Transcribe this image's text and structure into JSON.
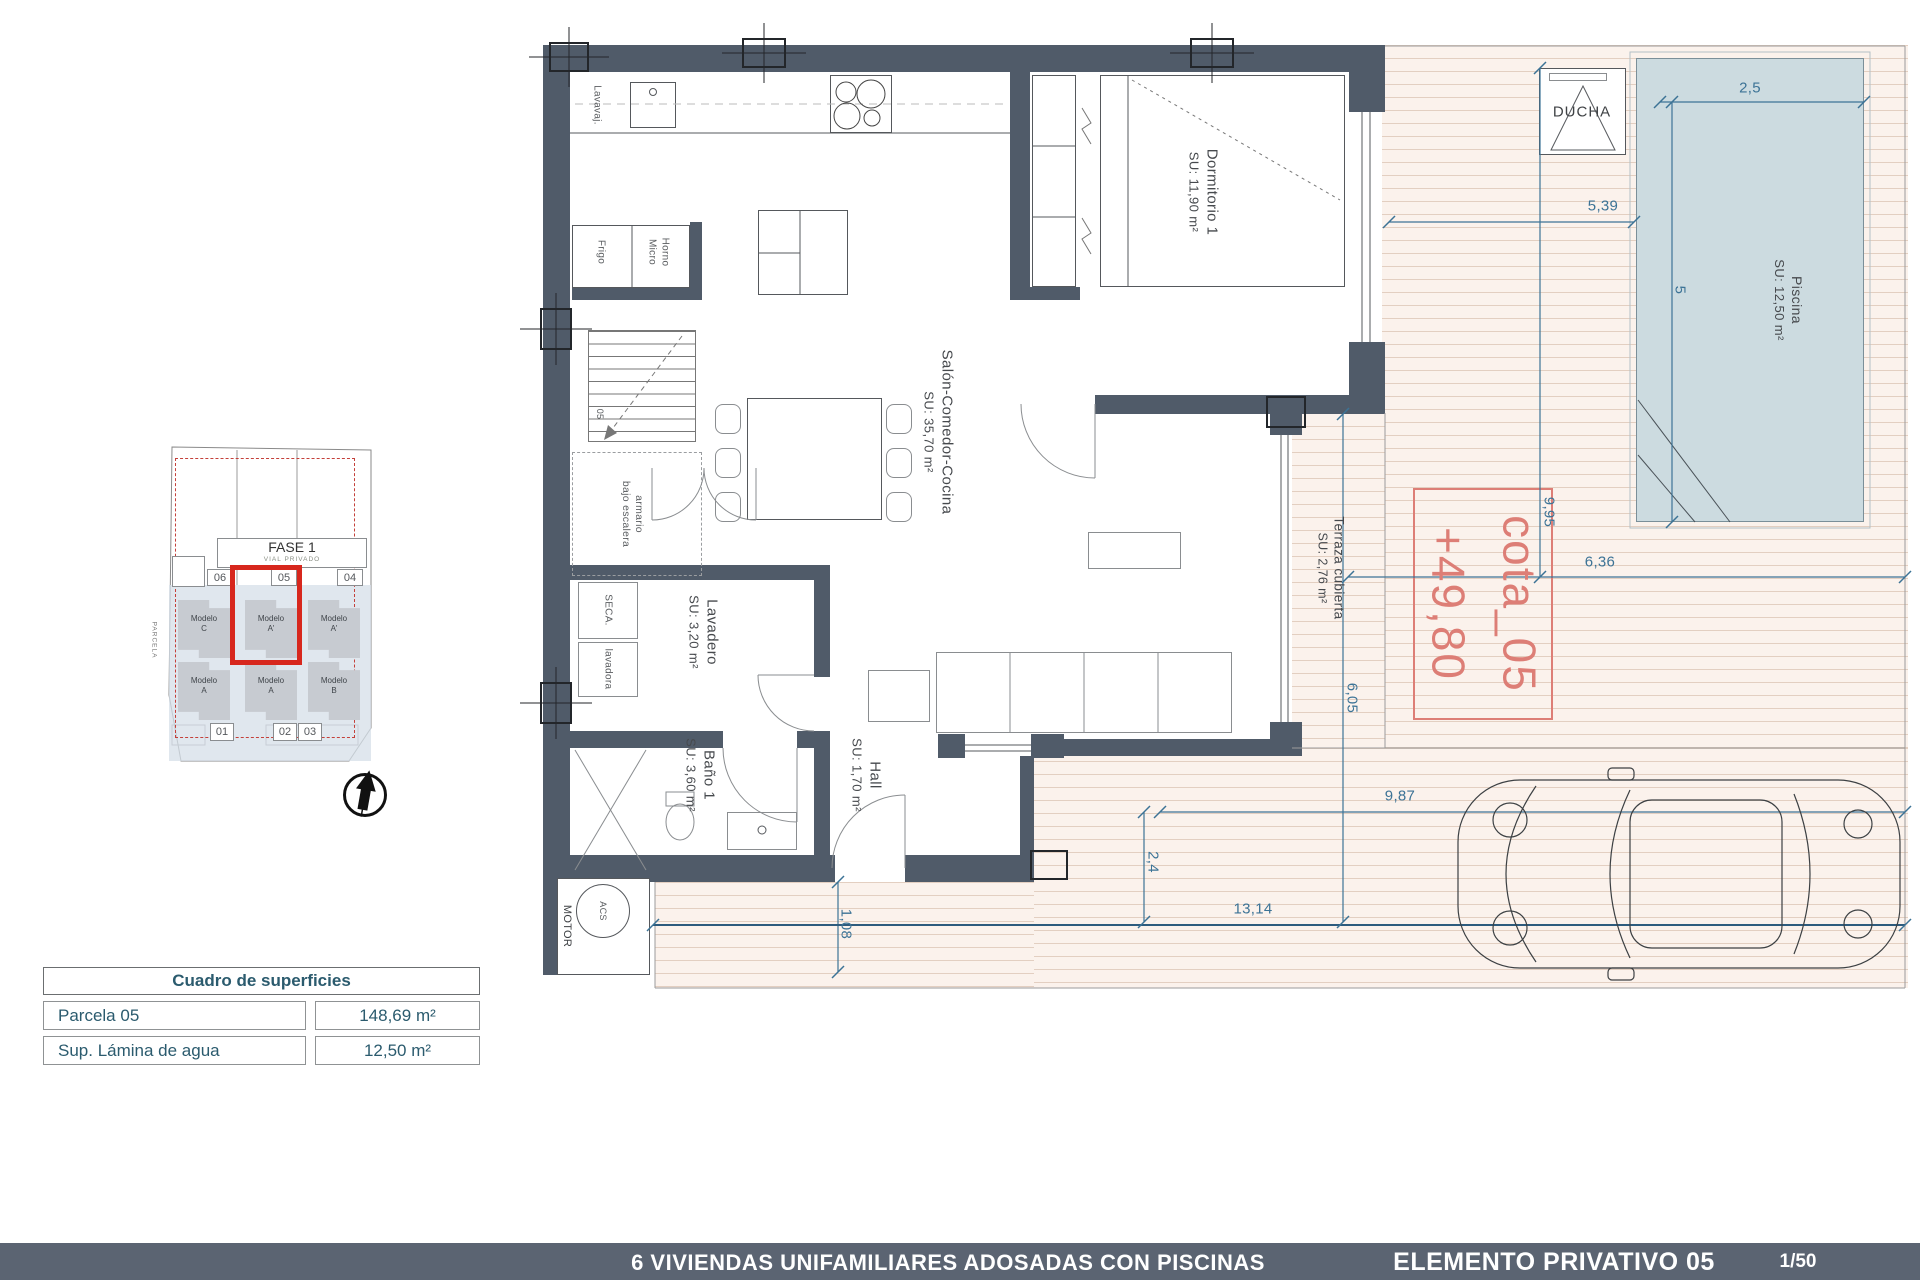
{
  "colors": {
    "wall": "#505b69",
    "deck_bg": "#fbf2ec",
    "deck_line": "#e3cfc1",
    "pool": "#ccdbe0",
    "dim_blue": "#3c7396",
    "red_highlight": "#d7271d",
    "cota_red": "#dd7e76",
    "footer_bg": "#5b6472",
    "table_text": "#2b5b6e"
  },
  "rooms": {
    "dormitorio": {
      "name": "Dormitorio 1",
      "area": "SU: 11,90 m²"
    },
    "salon": {
      "name": "Salón-Comedor-Cocina",
      "area": "SU: 35,70 m²"
    },
    "lavadero": {
      "name": "Lavadero",
      "area": "SU: 3,20 m²"
    },
    "bano": {
      "name": "Baño 1",
      "area": "SU: 3,60 m²"
    },
    "hall": {
      "name": "Hall",
      "area": "SU: 1,70 m²"
    },
    "terraza": {
      "name": "Terraza cubierta",
      "area": "SU: 2,76 m²"
    },
    "piscina": {
      "name": "Piscina",
      "area": "SU: 12,50 m²"
    }
  },
  "fixtures": {
    "lavavajillas": "Lavavaj.",
    "frigo": "Frigo",
    "horno": [
      "Horno",
      "Micro"
    ],
    "seca": "SECA.",
    "lavadora": "lavadora",
    "armario": [
      "armario",
      "bajo escalera"
    ],
    "motor": "MOTOR",
    "acs": "ACS",
    "ducha": "DUCHA",
    "stair": "05"
  },
  "cota": {
    "name": "cota_05",
    "level": "+49,80"
  },
  "dimensions": {
    "pool_width": "2,5",
    "pool_length": "5",
    "deck_to_pool": "5,39",
    "plot_depth_right": "9,95",
    "terrace_width": "6,36",
    "terrace_depth": "6,05",
    "drive_width": "9,87",
    "drive_depth": "2,4",
    "plot_width": "13,14",
    "side_strip": "1,08"
  },
  "site_plan": {
    "fase": "FASE 1",
    "vial": "VIAL PRIVADO",
    "parcela": "PARCELA",
    "plots_top": [
      "06",
      "05",
      "04"
    ],
    "plots_bottom": [
      "01",
      "02",
      "03"
    ],
    "models_top": [
      [
        "Modelo",
        "C"
      ],
      [
        "Modelo",
        "A'"
      ],
      [
        "Modelo",
        "A'"
      ]
    ],
    "models_bottom": [
      [
        "Modelo",
        "A"
      ],
      [
        "Modelo",
        "A"
      ],
      [
        "Modelo",
        "B"
      ]
    ]
  },
  "surface_table": {
    "title": "Cuadro de superficies",
    "rows": [
      {
        "label": "Parcela 05",
        "value": "148,69 m²"
      },
      {
        "label": "Sup. Lámina de agua",
        "value": "12,50 m²"
      }
    ]
  },
  "footer": {
    "project": "6 VIVIENDAS UNIFAMILIARES ADOSADAS CON PISCINAS",
    "sheet": "ELEMENTO PRIVATIVO 05",
    "scale": "1/50"
  }
}
